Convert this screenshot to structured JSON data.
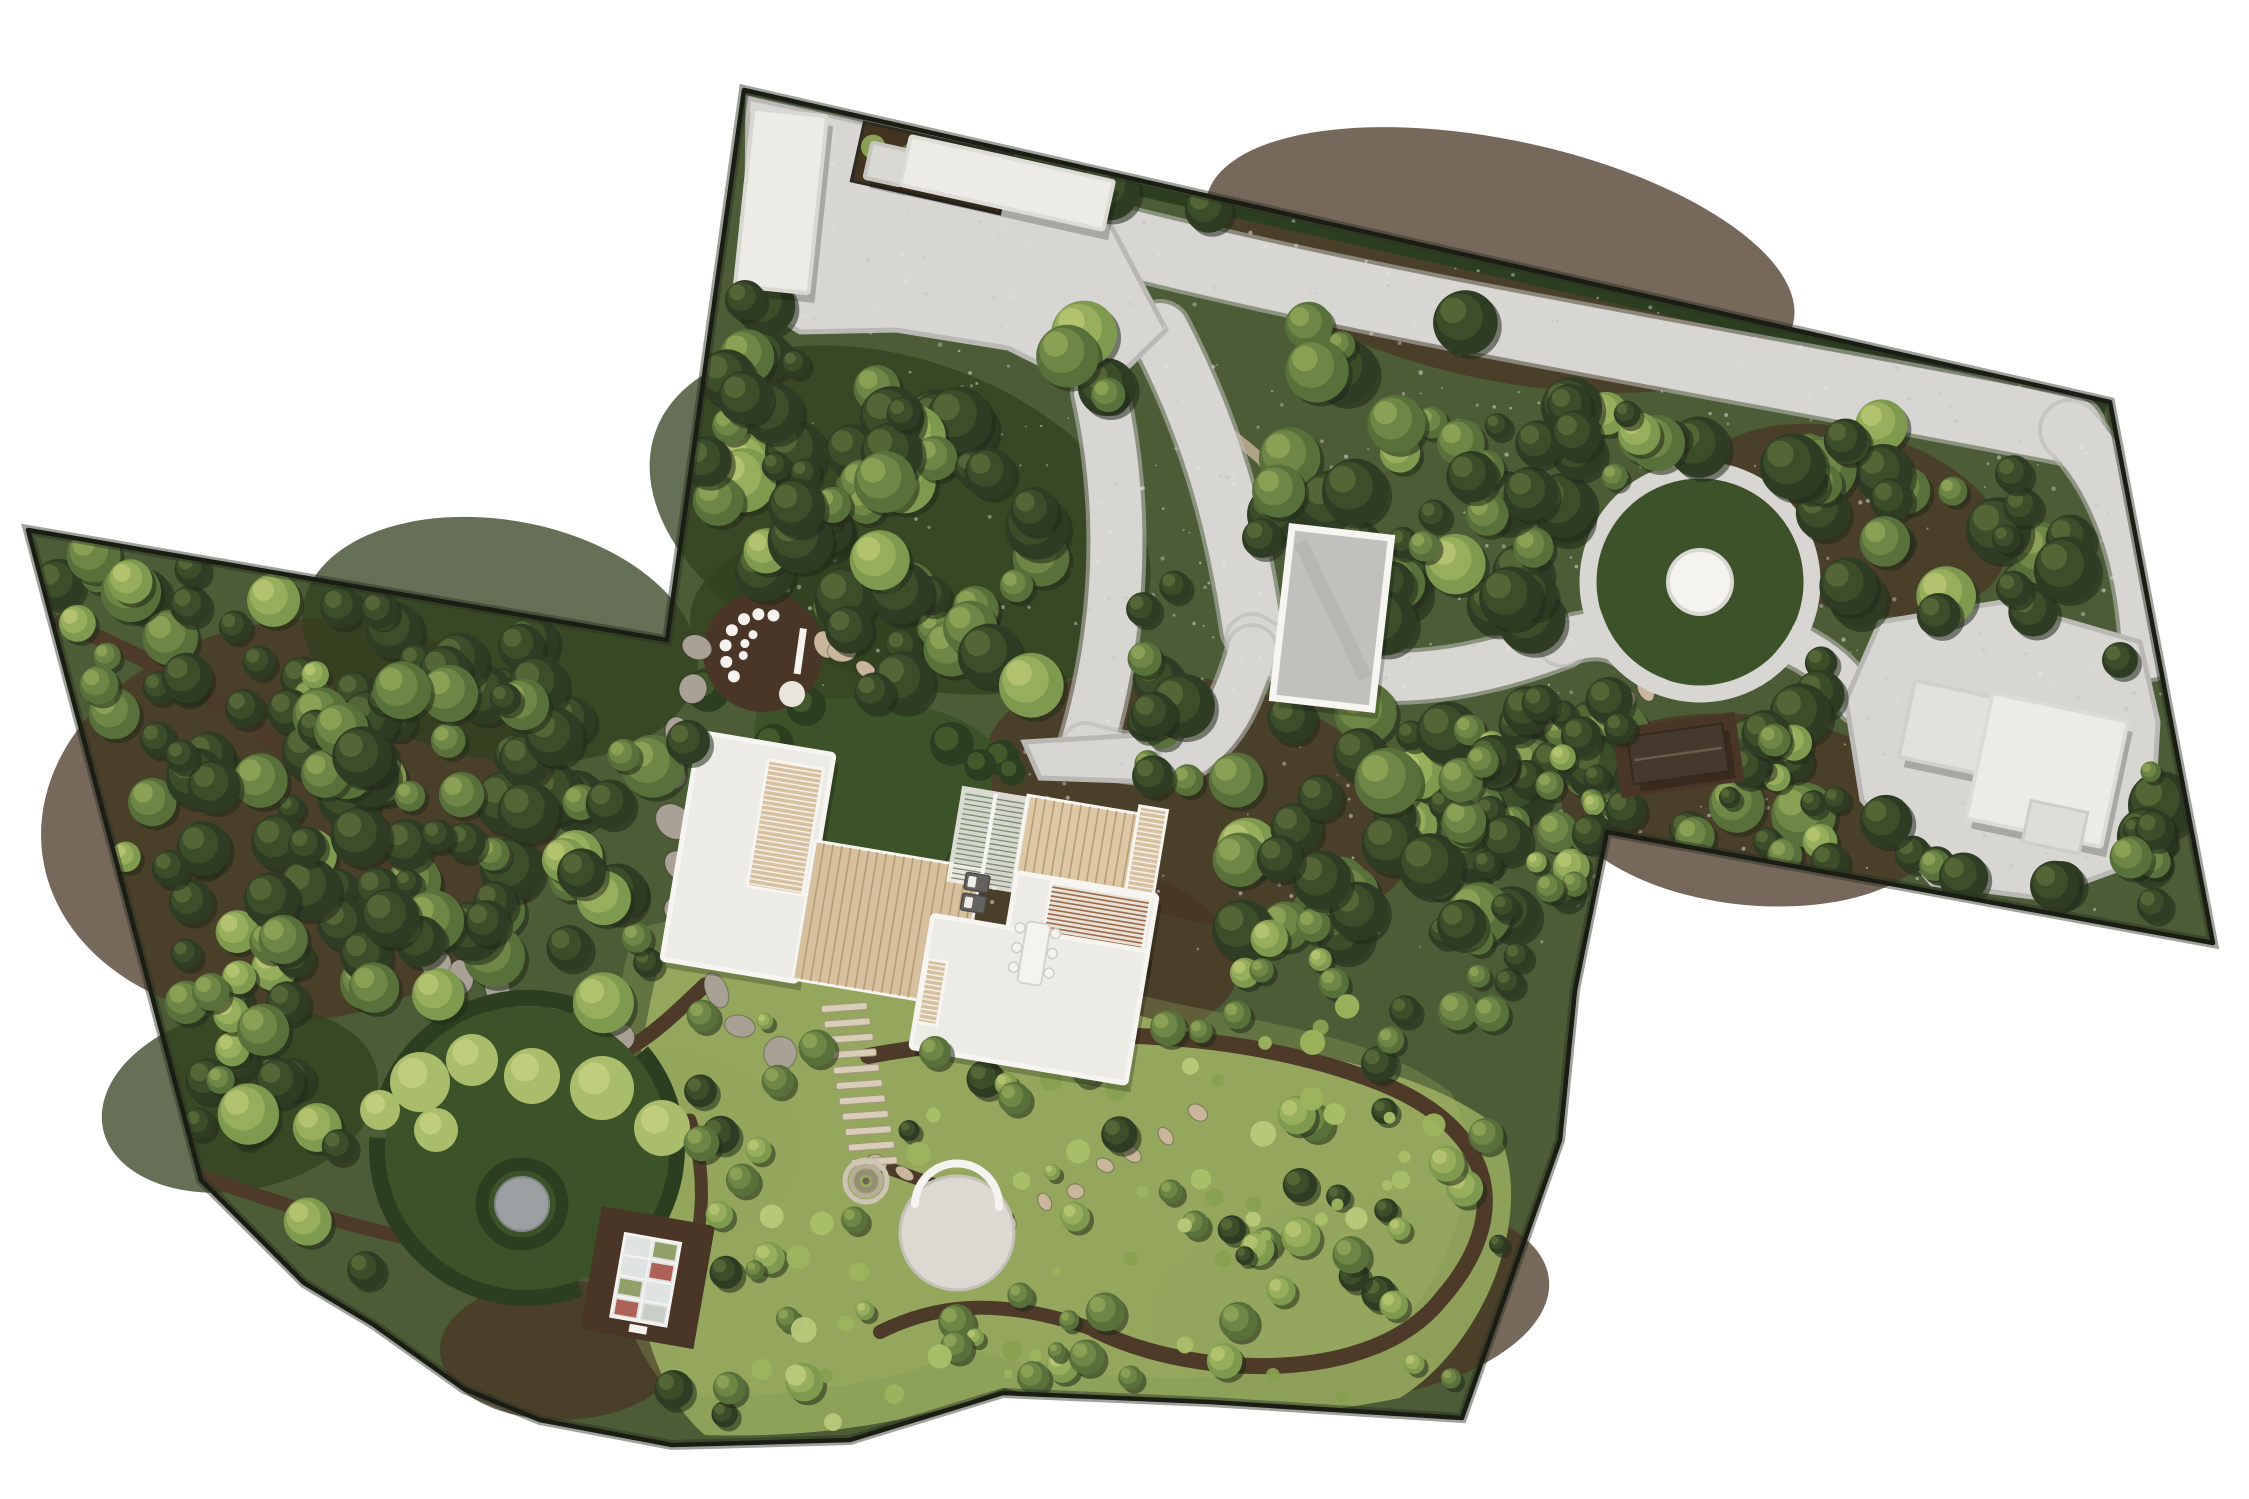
{
  "meta": {
    "name": "aerial-landscape-master-plan",
    "canvas": {
      "w": 2249,
      "h": 1499
    }
  },
  "palette": {
    "bg": "#ffffff",
    "boundary": "#1a1d14",
    "forestBase": "#4b5c36",
    "forestShade": "#31401f",
    "mulch": "#4a3626",
    "trail": "#4e3a28",
    "softPath": "#bcab8f",
    "gravel": "#d7d6d3",
    "gravelEdge": "#b9b8b4",
    "roofWhite": "#edebe6",
    "roofGray": "#c2c0bc",
    "parapet": "#f6f5f1",
    "wood": "#d6c09e",
    "woodLight": "#ddc8a6",
    "woodLine": "#b89b74",
    "louverBrown": "#9c6a4a",
    "louverDark": "#6f5a44",
    "lawn": "#3c5329",
    "hedge": "#2c3e20",
    "hedgeLight": "#49612e",
    "meadow": "#93a75c",
    "meadowLight": "#aabd6b",
    "stoneGray": "#a9a195",
    "stoneTan": "#c9b69c",
    "pond": "#9aa0a1",
    "white": "#f4f3ef",
    "saunaRoof": "#45382c",
    "glass": "#dfe3e1",
    "shadow": "rgba(0,0,0,0.22)"
  },
  "site": {
    "outline": [
      [
        744,
        90
      ],
      [
        2110,
        402
      ],
      [
        2213,
        943
      ],
      [
        1607,
        832
      ],
      [
        1575,
        990
      ],
      [
        1560,
        1140
      ],
      [
        1462,
        1418
      ],
      [
        1210,
        1402
      ],
      [
        1003,
        1393
      ],
      [
        850,
        1440
      ],
      [
        672,
        1445
      ],
      [
        540,
        1420
      ],
      [
        464,
        1389
      ],
      [
        374,
        1325
      ],
      [
        304,
        1283
      ],
      [
        201,
        1180
      ],
      [
        28,
        530
      ],
      [
        667,
        640
      ]
    ]
  },
  "mulch_patches": [
    [
      900,
      520,
      260,
      160,
      20
    ],
    [
      1500,
      260,
      300,
      120,
      12
    ],
    [
      300,
      820,
      260,
      200,
      -8
    ],
    [
      500,
      640,
      200,
      120,
      10
    ],
    [
      1750,
      810,
      190,
      95,
      6
    ],
    [
      1200,
      800,
      220,
      120,
      14
    ],
    [
      650,
      1150,
      150,
      100,
      0
    ],
    [
      1350,
      1300,
      200,
      100,
      -6
    ],
    [
      560,
      1350,
      120,
      70,
      0
    ],
    [
      820,
      620,
      130,
      85,
      0
    ],
    [
      1850,
      520,
      160,
      90,
      15
    ],
    [
      1080,
      950,
      160,
      90,
      8
    ],
    [
      240,
      1100,
      140,
      90,
      -12
    ]
  ],
  "meadow": {
    "d": "M660,960 C790,915 990,955 1105,1005 C1255,1055 1395,1050 1495,1125 C1540,1210 1485,1345 1400,1398 C1255,1428 1105,1418 1005,1388 C905,1428 795,1438 705,1435 C628,1372 605,1180 660,960 Z"
  },
  "trails": [
    {
      "d": "M705,985 C648,1040 606,1078 566,1044",
      "w": 15
    },
    {
      "d": "M872,1162 C940,1188 975,1196 1008,1218",
      "w": 13
    },
    {
      "d": "M868,1056 C1010,1030 1210,1018 1378,1082 C1500,1130 1512,1218 1442,1298 C1372,1388 1190,1378 1095,1330",
      "w": 16
    },
    {
      "d": "M1095,1330 C1005,1298 940,1302 880,1332",
      "w": 14
    },
    {
      "d": "M440,1003 C500,1010 540,1025 566,1044",
      "w": 13
    },
    {
      "d": "M62,622 C250,700 375,798 420,958 C442,1058 520,1098 566,1044",
      "w": 16
    },
    {
      "d": "M205,1178 C300,1210 390,1240 470,1248 C520,1252 560,1262 600,1272",
      "w": 14
    },
    {
      "d": "M690,1120 C712,1190 702,1260 662,1320",
      "w": 13
    }
  ],
  "soft_paths": [
    {
      "d": "M1205,415 C1260,455 1320,505 1340,560",
      "w": 11
    },
    {
      "d": "M1340,560 C1365,600 1382,622 1398,642",
      "w": 10
    }
  ],
  "gravel": {
    "polys": [
      {
        "name": "entry-courtyard",
        "d": "M748,98 L982,148 L1108,220 L1166,330 L1100,394 L1008,348 L896,330 L800,332 L746,298 Z"
      },
      {
        "name": "east-gravel-court",
        "d": "M1846,700 L1880,622 L2002,602 L2140,642 L2158,722 L2150,858 L2040,898 L1932,884 L1862,800 Z"
      },
      {
        "name": "house-apron",
        "d": "M1024,742 L1156,734 L1160,782 L1040,778 Z"
      }
    ],
    "strokes": [
      {
        "name": "top-driveway",
        "d": "M1108,238 C1400,312 1700,358 2070,430",
        "w": 66
      },
      {
        "name": "east-descent",
        "d": "M2070,430 C2122,484 2146,562 2150,650",
        "w": 56
      },
      {
        "name": "court-branch",
        "d": "M1160,332 C1212,432 1236,522 1252,628",
        "w": 58
      },
      {
        "name": "house-branch",
        "d": "M1100,392 C1128,520 1118,640 1086,748",
        "w": 52
      },
      {
        "name": "garage-link",
        "d": "M1252,640 C1332,690 1442,688 1562,642",
        "w": 48
      },
      {
        "name": "circle-link",
        "d": "M1562,642 C1600,628 1622,636 1652,662",
        "w": 44
      },
      {
        "name": "court-link",
        "d": "M1795,645 C1830,662 1848,682 1858,702",
        "w": 40
      },
      {
        "name": "apron-link",
        "d": "M1086,748 C1125,760 1155,762 1185,756",
        "w": 46
      },
      {
        "name": "apron-link2",
        "d": "M1185,756 C1220,736 1238,700 1252,650",
        "w": 46
      }
    ]
  },
  "house_lawn": {
    "d": "M758,706 C852,688 952,700 992,742 L992,850 C942,882 902,880 872,900 C822,906 792,882 772,862 C750,802 750,752 758,706 Z",
    "hedges": [
      [
        768,
        795,
        26
      ],
      [
        780,
        850,
        22
      ],
      [
        858,
        888,
        24
      ],
      [
        918,
        886,
        20
      ],
      [
        962,
        866,
        18
      ],
      [
        774,
        744,
        20
      ],
      [
        952,
        744,
        22
      ],
      [
        1002,
        758,
        18
      ],
      [
        708,
        690,
        22
      ],
      [
        806,
        706,
        20
      ],
      [
        980,
        765,
        16
      ],
      [
        1012,
        772,
        14
      ]
    ]
  },
  "seating_circle": {
    "cx": 763,
    "cy": 652,
    "r": 60,
    "stool_r": 6,
    "outer_ring": 38,
    "inner_ring": 20,
    "outer_angles": [
      140,
      165,
      190,
      215,
      240,
      263,
      286
    ],
    "inner_angles": [
      170,
      205,
      240
    ],
    "bench": {
      "x": 800,
      "y": 628,
      "w": 7,
      "h": 46,
      "rot": 8
    },
    "big_stool": [
      792,
      694,
      13
    ]
  },
  "flag_routes": [
    {
      "pts": [
        [
          700,
          648
        ],
        [
          672,
          760
        ],
        [
          676,
          886
        ],
        [
          714,
          994
        ],
        [
          776,
          1054
        ]
      ],
      "n": 11,
      "s": 17,
      "c": "stoneGray"
    },
    {
      "pts": [
        [
          822,
          642
        ],
        [
          904,
          694
        ]
      ],
      "n": 5,
      "s": 12,
      "c": "stoneTan"
    },
    {
      "pts": [
        [
          1012,
          1222
        ],
        [
          1120,
          1160
        ],
        [
          1196,
          1116
        ]
      ],
      "n": 7,
      "s": 9,
      "c": "stoneTan"
    },
    {
      "pts": [
        [
          434,
          962
        ],
        [
          540,
          1012
        ],
        [
          622,
          1042
        ]
      ],
      "n": 7,
      "s": 15,
      "c": "stoneGray"
    },
    {
      "pts": [
        [
          1648,
          688
        ],
        [
          1610,
          716
        ]
      ],
      "n": 3,
      "s": 11,
      "c": "stoneTan"
    },
    {
      "pts": [
        [
          566,
          1078
        ],
        [
          640,
          1106
        ]
      ],
      "n": 4,
      "s": 12,
      "c": "stoneGray"
    },
    {
      "pts": [
        [
          876,
          1166
        ],
        [
          930,
          1186
        ]
      ],
      "n": 3,
      "s": 9,
      "c": "stoneTan"
    }
  ],
  "steps": {
    "x0": 844,
    "y0": 1004,
    "x1": 874,
    "y1": 1158,
    "n": 11,
    "w": 46,
    "h": 7,
    "rot": -4
  },
  "circle_garden": {
    "cx": 527,
    "cy": 1148,
    "lawn_r": 142,
    "hedge_r": 150,
    "hedge_w": 16,
    "hedge_dash": "250 36 300 44 230 82",
    "dash_rot": -40,
    "shrubs": [
      [
        420,
        1082,
        30
      ],
      [
        472,
        1060,
        26
      ],
      [
        532,
        1076,
        28
      ],
      [
        602,
        1088,
        32
      ],
      [
        662,
        1128,
        28
      ],
      [
        436,
        1130,
        22
      ],
      [
        380,
        1110,
        20
      ]
    ],
    "pond": {
      "cx": 522,
      "cy": 1204,
      "hedge_r": 40,
      "hedge_w": 13,
      "disc_r": 27
    }
  },
  "greenhouse": {
    "cx": 647,
    "cy": 1278,
    "rot": 10,
    "patio": [
      590,
      1215,
      115,
      125
    ],
    "glass": [
      618,
      1238,
      56,
      84
    ],
    "cells": [
      [
        "#a04034",
        1,
        1
      ],
      [
        "#7d8d4a",
        0,
        2
      ],
      [
        "#c2c8bf",
        1,
        3
      ],
      [
        "#a04034",
        0,
        3
      ],
      [
        "#7d8d4a",
        1,
        0
      ]
    ]
  },
  "circle_lawn": {
    "cx": 1700,
    "cy": 582,
    "ring_r": 112,
    "ring_w": 17,
    "lawn_r": 103,
    "disc_r": 30
  },
  "patio": {
    "cx": 957,
    "cy": 1233,
    "r": 57,
    "bench_d": "M915,1204 A42,42 0 0 1 999,1207"
  },
  "fountain": {
    "cx": 866,
    "cy": 1181,
    "rings": [
      21,
      15,
      9
    ]
  },
  "buildings": {
    "garage": {
      "x": 744,
      "y": 112,
      "w": 74,
      "h": 178,
      "rot": 6
    },
    "wall_building": {
      "x": 903,
      "y": 158,
      "w": 208,
      "h": 50,
      "rot": 12.5
    },
    "wall_annex": {
      "x": 868,
      "y": 146,
      "w": 36,
      "h": 36,
      "rot": 12.5
    },
    "planter": {
      "x": 856,
      "y": 138,
      "w": 152,
      "h": 60,
      "rot": 12.5
    },
    "rear_garage": {
      "x": 1282,
      "y": 532,
      "w": 100,
      "h": 172,
      "rot": 6.5
    },
    "sauna": {
      "x": 1630,
      "y": 730,
      "w": 96,
      "h": 48,
      "rot": -8
    },
    "east_small": {
      "x": 1906,
      "y": 688,
      "w": 80,
      "h": 78,
      "rot": 12
    },
    "east_large": {
      "x": 1978,
      "y": 706,
      "w": 138,
      "h": 128,
      "rot": 12
    },
    "east_notch": {
      "x": 2026,
      "y": 806,
      "w": 58,
      "h": 42,
      "rot": 12
    }
  },
  "house": {
    "rot": 9.5,
    "cx": 915,
    "cy": 895,
    "left_wing": [
      676,
      770,
      136,
      230
    ],
    "left_pergola": [
      748,
      786,
      56,
      128
    ],
    "deck": [
      808,
      858,
      168,
      140
    ],
    "white_pergola": [
      946,
      782,
      64,
      92
    ],
    "upper_deck": [
      1010,
      778,
      136,
      78
    ],
    "east_slats": [
      1122,
      770,
      28,
      112
    ],
    "rw_upper": [
      1012,
      856,
      142,
      74
    ],
    "rw_louver": [
      1048,
      860,
      100,
      60
    ],
    "rw_lower": [
      936,
      912,
      218,
      134
    ],
    "small_louver": [
      938,
      956,
      20,
      64
    ],
    "loungers": [
      [
        962,
        864,
        24,
        17
      ],
      [
        962,
        885,
        24,
        17
      ]
    ],
    "table": [
      1030,
      902,
      24,
      62
    ],
    "chairs": [
      [
        1024,
        910
      ],
      [
        1024,
        930
      ],
      [
        1024,
        950
      ],
      [
        1060,
        910
      ],
      [
        1060,
        930
      ],
      [
        1060,
        950
      ]
    ]
  },
  "forest": {
    "seed": 11,
    "zones": [
      {
        "x": 700,
        "y": 100,
        "w": 1500,
        "h": 840,
        "n": 250,
        "rmin": 13,
        "rmax": 34,
        "mix": [
          0.6,
          0.3,
          0.1
        ]
      },
      {
        "x": 30,
        "y": 540,
        "w": 640,
        "h": 780,
        "n": 160,
        "rmin": 13,
        "rmax": 32,
        "mix": [
          0.55,
          0.3,
          0.15
        ]
      },
      {
        "x": 640,
        "y": 950,
        "w": 900,
        "h": 480,
        "n": 80,
        "rmin": 8,
        "rmax": 20,
        "mix": [
          0.2,
          0.4,
          0.4
        ]
      },
      {
        "x": 1450,
        "y": 700,
        "w": 720,
        "h": 240,
        "n": 55,
        "rmin": 10,
        "rmax": 26,
        "mix": [
          0.5,
          0.35,
          0.15
        ]
      }
    ],
    "shrub_zone": {
      "x": 700,
      "y": 1000,
      "w": 800,
      "h": 430,
      "n": 70
    },
    "exclusions": [
      [
        950,
        245,
        150
      ],
      [
        1180,
        300,
        95
      ],
      [
        780,
        200,
        100
      ],
      [
        1010,
        190,
        80
      ],
      [
        1120,
        262,
        60
      ],
      [
        1258,
        292,
        60
      ],
      [
        1396,
        318,
        60
      ],
      [
        1534,
        342,
        60
      ],
      [
        1672,
        366,
        60
      ],
      [
        1810,
        390,
        60
      ],
      [
        1948,
        410,
        60
      ],
      [
        2066,
        430,
        60
      ],
      [
        2112,
        500,
        55
      ],
      [
        2140,
        580,
        50
      ],
      [
        2150,
        650,
        50
      ],
      [
        1172,
        380,
        60
      ],
      [
        1205,
        470,
        60
      ],
      [
        1230,
        560,
        60
      ],
      [
        1250,
        630,
        60
      ],
      [
        1108,
        450,
        55
      ],
      [
        1100,
        550,
        55
      ],
      [
        1090,
        650,
        55
      ],
      [
        1086,
        740,
        55
      ],
      [
        1320,
        668,
        50
      ],
      [
        1410,
        680,
        50
      ],
      [
        1500,
        664,
        50
      ],
      [
        1580,
        636,
        50
      ],
      [
        1640,
        660,
        50
      ],
      [
        1700,
        582,
        130
      ],
      [
        2010,
        750,
        135
      ],
      [
        1905,
        690,
        70
      ],
      [
        1860,
        740,
        60
      ],
      [
        1678,
        757,
        62
      ],
      [
        760,
        860,
        130
      ],
      [
        905,
        905,
        160
      ],
      [
        1065,
        905,
        150
      ],
      [
        1000,
        800,
        100
      ],
      [
        770,
        765,
        85
      ],
      [
        880,
        790,
        95
      ],
      [
        763,
        652,
        72
      ],
      [
        957,
        1233,
        82
      ],
      [
        866,
        1181,
        40
      ],
      [
        860,
        1085,
        50
      ],
      [
        527,
        1150,
        165
      ],
      [
        522,
        1204,
        50
      ],
      [
        647,
        1278,
        66
      ]
    ]
  },
  "over_trees": [
    [
      688,
      742,
      22,
      0
    ],
    [
      1168,
      1028,
      18,
      1
    ],
    [
      935,
      1052,
      16,
      1
    ],
    [
      1262,
      538,
      20,
      0
    ],
    [
      1620,
      728,
      16,
      0
    ],
    [
      2120,
      660,
      18,
      0
    ],
    [
      745,
      300,
      20,
      0
    ]
  ]
}
